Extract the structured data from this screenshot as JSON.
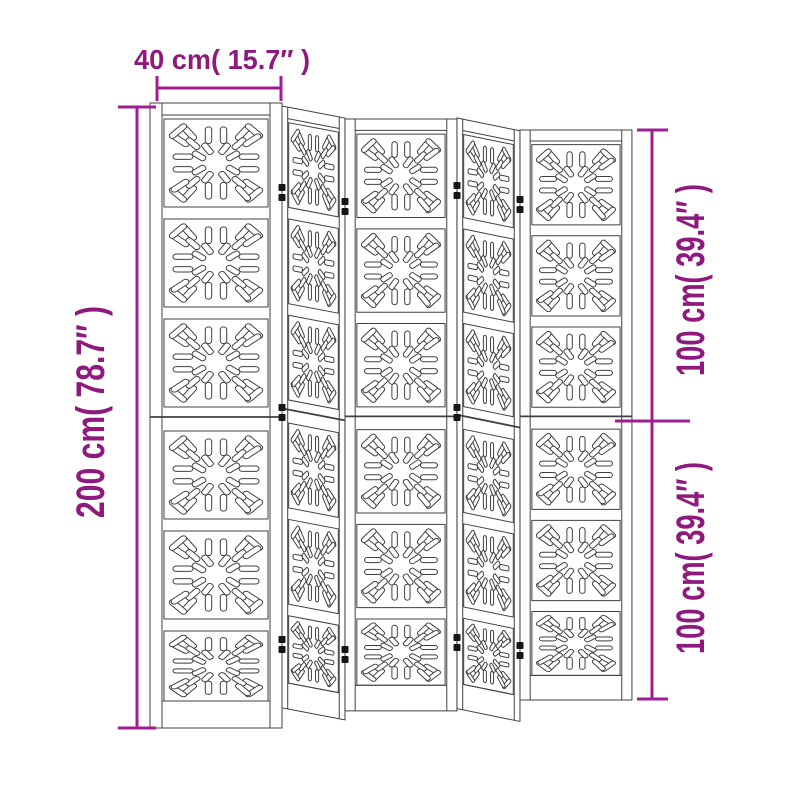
{
  "figure": {
    "type": "product-dimension-diagram",
    "subject": "5-panel folding room divider with sunburst cut-out pattern",
    "panel_count": 5,
    "pattern_cells_per_panel": 6
  },
  "dimensions": {
    "top_width_label": "40 cm( 15.7″ )",
    "left_height_label": "200 cm( 78.7″ )",
    "right_upper_label": "100 cm( 39.4″ )",
    "right_lower_label": "100 cm( 39.4″ )"
  },
  "colors": {
    "dimension_line": "#A01F90",
    "dimension_text": "#8E1A7E",
    "artwork_line": "#404040",
    "background": "#FFFFFF"
  }
}
